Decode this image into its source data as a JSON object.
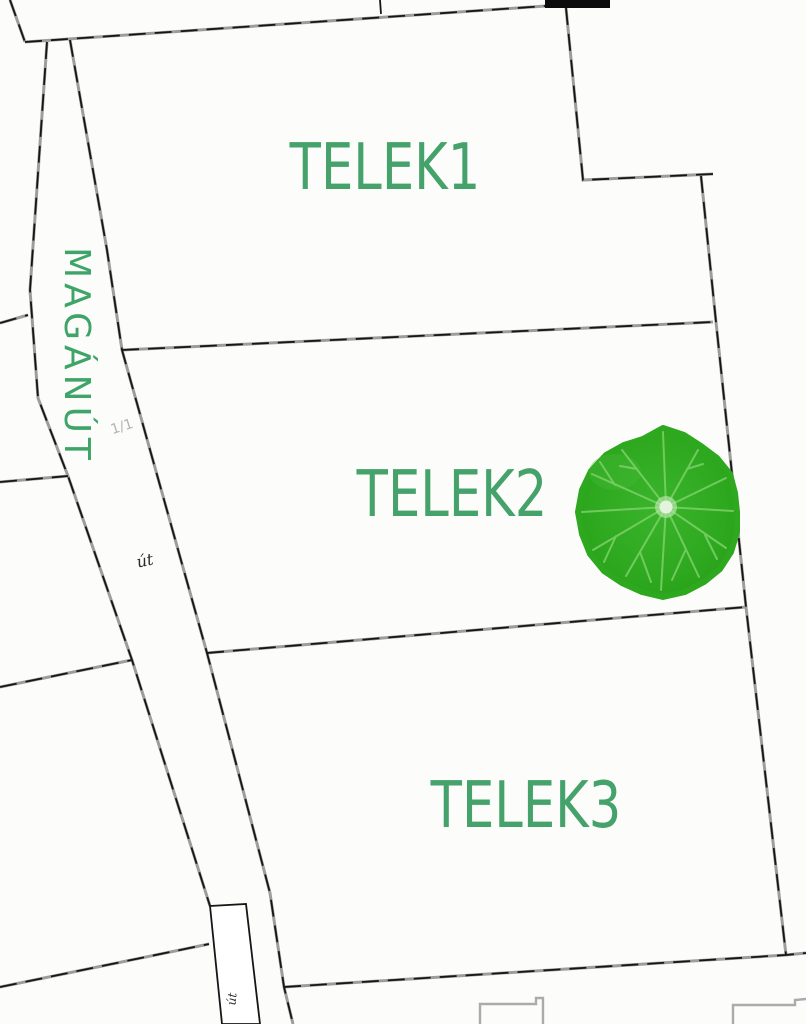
{
  "map": {
    "title": "cadastral parcel map",
    "parcels": [
      {
        "label": "TELEK1"
      },
      {
        "label": "TELEK2"
      },
      {
        "label": "TELEK3"
      }
    ],
    "road": {
      "name": "MAGÁNÚT",
      "surface_label": "út",
      "surface_label_bottom": "út",
      "parcel_fraction": "1/1"
    },
    "symbols": {
      "leaf": "green-nasturtium-leaf-marker"
    },
    "colors": {
      "parcel_label_green": "#44a26a",
      "road_name_green": "#3fa468",
      "boundary_dark": "#161616",
      "boundary_gray": "#9d9d9d",
      "building_gray": "#ababab",
      "leaf_fill": "#2ea81f",
      "leaf_vein": "#7cd168",
      "leaf_center": "#e2f4dc",
      "faint_text_gray": "#b3b3b3",
      "background": "#fcfdfb"
    }
  }
}
